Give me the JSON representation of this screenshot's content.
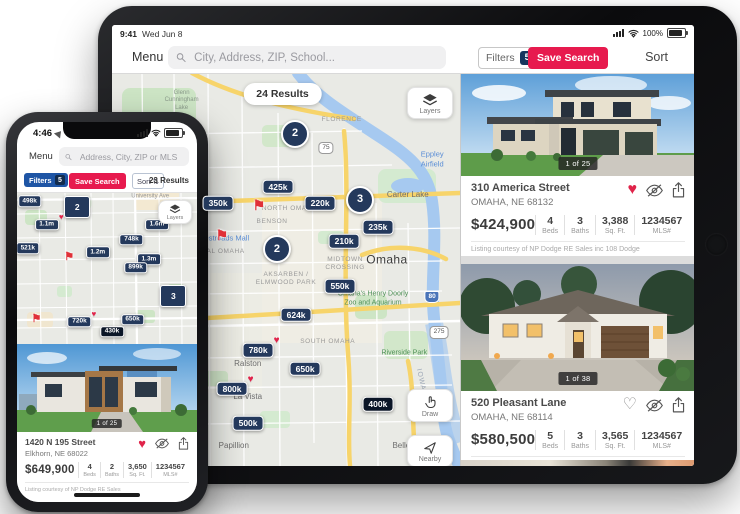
{
  "ipad": {
    "status": {
      "time": "9:41",
      "date": "Wed Jun 8",
      "battery_pct": "100%"
    },
    "toolbar": {
      "menu": "Menu",
      "search_placeholder": "City, Address, ZIP, School...",
      "filters": "Filters",
      "filters_count": "5",
      "save_search": "Save Search",
      "sort": "Sort"
    },
    "map": {
      "results": "24 Results",
      "layers": "Layers",
      "draw": "Draw",
      "nearby": "Nearby",
      "pins": [
        {
          "label": "2",
          "x": 52.6,
          "y": 15.4,
          "cls": "pin-cluster"
        },
        {
          "label": "425k",
          "x": 47.7,
          "y": 29.0,
          "cls": "pin-price"
        },
        {
          "label": "350k",
          "x": 30.5,
          "y": 33.2,
          "cls": "pin-price"
        },
        {
          "label": "220k",
          "x": 59.8,
          "y": 33.2,
          "cls": "pin-price"
        },
        {
          "label": "3",
          "x": 71.3,
          "y": 32.2,
          "cls": "pin-cluster"
        },
        {
          "label": "⚑",
          "x": 42.2,
          "y": 33.7,
          "cls": "pin-flag"
        },
        {
          "label": "235k",
          "x": 76.4,
          "y": 39.2,
          "cls": "pin-price"
        },
        {
          "label": "⚑",
          "x": 31.6,
          "y": 41.3,
          "cls": "pin-flag"
        },
        {
          "label": "210k",
          "x": 66.7,
          "y": 42.8,
          "cls": "pin-price"
        },
        {
          "label": "2",
          "x": 47.4,
          "y": 44.8,
          "cls": "pin-cluster"
        },
        {
          "label": "550k",
          "x": 65.5,
          "y": 54.2,
          "cls": "pin-price"
        },
        {
          "label": "624k",
          "x": 52.9,
          "y": 61.5,
          "cls": "pin-price"
        },
        {
          "label": "780k",
          "x": 42.0,
          "y": 70.6,
          "cls": "pin-price",
          "heart": true
        },
        {
          "label": "650k",
          "x": 55.5,
          "y": 75.2,
          "cls": "pin-price"
        },
        {
          "label": "800k",
          "x": 34.5,
          "y": 80.3,
          "cls": "pin-price",
          "heart": true
        },
        {
          "label": "400k",
          "x": 76.4,
          "y": 84.3,
          "cls": "pin-dark"
        },
        {
          "label": "500k",
          "x": 39.1,
          "y": 89.1,
          "cls": "pin-price"
        }
      ],
      "labels": [
        {
          "text": "Glenn\nCunningham\nLake",
          "x": 20,
          "y": 7,
          "cls": "lbl-poi"
        },
        {
          "text": "FLORENCE",
          "x": 66,
          "y": 12,
          "cls": "lbl-area"
        },
        {
          "text": "Eppley\nAirfield",
          "x": 92,
          "y": 22,
          "cls": "lbl-water"
        },
        {
          "text": "Carter Lake",
          "x": 85,
          "y": 31,
          "cls": "lbl-town"
        },
        {
          "text": "NORTH OMAHA",
          "x": 51,
          "y": 34.5,
          "cls": "lbl-area"
        },
        {
          "text": "BENSON",
          "x": 46,
          "y": 38,
          "cls": "lbl-area"
        },
        {
          "text": "Westroads Mall",
          "x": 32,
          "y": 42,
          "cls": "lbl-water"
        },
        {
          "text": "CENTRAL OMAHA",
          "x": 29,
          "y": 45.5,
          "cls": "lbl-area"
        },
        {
          "text": "MIDTOWN\nCROSSING",
          "x": 67,
          "y": 48.5,
          "cls": "lbl-area"
        },
        {
          "text": "Omaha",
          "x": 79,
          "y": 47.5,
          "cls": "lbl-city"
        },
        {
          "text": "AKSARBEN /\nELMWOOD PARK",
          "x": 50,
          "y": 52.5,
          "cls": "lbl-area"
        },
        {
          "text": "Omaha's Henry Doorly\nZoo and Aquarium",
          "x": 75,
          "y": 57.5,
          "cls": "lbl-park"
        },
        {
          "text": "SOUTH OMAHA",
          "x": 62,
          "y": 68.5,
          "cls": "lbl-area"
        },
        {
          "text": "Riverside Park",
          "x": 84,
          "y": 71.5,
          "cls": "lbl-park"
        },
        {
          "text": "Ralston",
          "x": 39,
          "y": 74,
          "cls": "lbl-town"
        },
        {
          "text": "La Vista",
          "x": 39,
          "y": 82.5,
          "cls": "lbl-town"
        },
        {
          "text": "Papillion",
          "x": 35,
          "y": 95,
          "cls": "lbl-town"
        },
        {
          "text": "Bellevue",
          "x": 85,
          "y": 95,
          "cls": "lbl-town"
        },
        {
          "text": "IOWA",
          "x": 88.5,
          "y": 78,
          "cls": "lbl-state"
        },
        {
          "text": "75",
          "x": 61.5,
          "y": 19,
          "cls": "shield-us"
        },
        {
          "text": "80",
          "x": 92,
          "y": 57,
          "cls": "shield-i"
        },
        {
          "text": "275",
          "x": 94,
          "y": 66,
          "cls": "shield-us"
        }
      ]
    },
    "panel": {
      "cards": [
        {
          "badge": "1 of 25",
          "address": "310 America Street",
          "city": "OMAHA, NE 68132",
          "price": "$424,900",
          "heart_glyph": "♥",
          "favorited": true,
          "stats": [
            {
              "value": "4",
              "label": "Beds"
            },
            {
              "value": "3",
              "label": "Baths"
            },
            {
              "value": "3,388",
              "label": "Sq. Ft."
            },
            {
              "value": "1234567",
              "label": "MLS#"
            }
          ],
          "courtesy": "Listing courtesy of NP Dodge RE Sales inc 108 Dodge"
        },
        {
          "badge": "1 of 38",
          "address": "520 Pleasant Lane",
          "city": "OMAHA, NE 68114",
          "price": "$580,500",
          "heart_glyph": "♡",
          "favorited": false,
          "stats": [
            {
              "value": "5",
              "label": "Beds"
            },
            {
              "value": "3",
              "label": "Baths"
            },
            {
              "value": "3,565",
              "label": "Sq. Ft."
            },
            {
              "value": "1234567",
              "label": "MLS#"
            }
          ],
          "courtesy": "Listing courtesy of NP Dodge RE Sales inc 108 Dodge"
        }
      ]
    }
  },
  "iphone": {
    "status": {
      "time": "4:46"
    },
    "toolbar": {
      "menu": "Menu",
      "search_placeholder": "Address, City, ZIP or MLS"
    },
    "filter_bar": {
      "filters": "Filters",
      "filters_count": "5",
      "save_search": "Save Search",
      "sort": "Sort",
      "sort_icon": "⇅",
      "results": "23 Results"
    },
    "map": {
      "layers": "Layers",
      "pins": [
        {
          "label": "498k",
          "x": 7,
          "y": 6,
          "cls": "pin-price"
        },
        {
          "label": "2",
          "x": 33.5,
          "y": 10.1,
          "cls": "pin-cluster"
        },
        {
          "label": "1.1m",
          "x": 16.5,
          "y": 21.5,
          "cls": "pin-price",
          "heart": true
        },
        {
          "label": "1.6m",
          "x": 77.8,
          "y": 21.5,
          "cls": "pin-price"
        },
        {
          "label": "748k",
          "x": 63.6,
          "y": 31.5,
          "cls": "pin-price"
        },
        {
          "label": "521k",
          "x": 6,
          "y": 36.9,
          "cls": "pin-price"
        },
        {
          "label": "1.2m",
          "x": 44.9,
          "y": 39.6,
          "cls": "pin-price"
        },
        {
          "label": "⚑",
          "x": 29,
          "y": 43,
          "cls": "pin-flag"
        },
        {
          "label": "1.3m",
          "x": 73.3,
          "y": 44.3,
          "cls": "pin-price"
        },
        {
          "label": "899k",
          "x": 65.9,
          "y": 49.7,
          "cls": "pin-price"
        },
        {
          "label": "3",
          "x": 86.9,
          "y": 68.5,
          "cls": "pin-cluster"
        },
        {
          "label": "⚑",
          "x": 10.8,
          "y": 83.9,
          "cls": "pin-flag"
        },
        {
          "label": "720k",
          "x": 34.7,
          "y": 85.2,
          "cls": "pin-price",
          "heart": true
        },
        {
          "label": "650k",
          "x": 64.2,
          "y": 83.9,
          "cls": "pin-price"
        },
        {
          "label": "430k",
          "x": 52.8,
          "y": 91.9,
          "cls": "pin-dark"
        }
      ],
      "labels": [
        {
          "text": "University Ave",
          "x": 74,
          "y": 3,
          "cls": "lbl-road"
        }
      ]
    },
    "card": {
      "badge": "1 of 25",
      "address": "1420 N 195 Street",
      "city": "Elkhorn, NE 68022",
      "price": "$649,900",
      "heart_glyph": "♥",
      "favorited": true,
      "stats": [
        {
          "value": "4",
          "label": "Beds"
        },
        {
          "value": "2",
          "label": "Baths"
        },
        {
          "value": "3,650",
          "label": "Sq. Ft."
        },
        {
          "value": "1234567",
          "label": "MLS#"
        }
      ],
      "courtesy": "Listing courtesy of NP Dodge RE Sales"
    }
  }
}
